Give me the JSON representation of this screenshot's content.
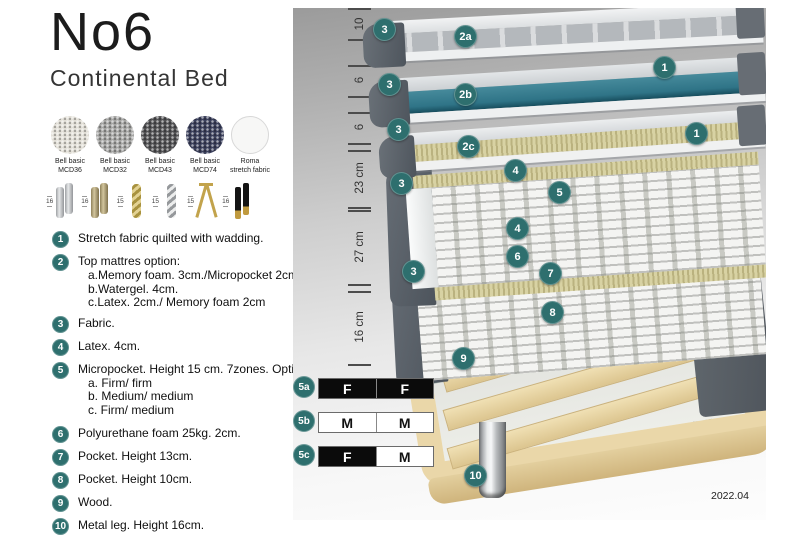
{
  "header": {
    "title": "No6",
    "subtitle": "Continental Bed"
  },
  "swatches": [
    {
      "line1": "Bell basic",
      "line2": "MCD36",
      "color": "#e2dfd7"
    },
    {
      "line1": "Bell basic",
      "line2": "MCD32",
      "color": "#a5a5a3"
    },
    {
      "line1": "Bell basic",
      "line2": "MCD43",
      "color": "#525254"
    },
    {
      "line1": "Bell basic",
      "line2": "MCD74",
      "color": "#3b405c"
    },
    {
      "line1": "Roma",
      "line2": "stretch fabric",
      "color": "#f7f7f6"
    }
  ],
  "legs": [
    {
      "height": "16",
      "type": "cylinder-silver"
    },
    {
      "height": "16",
      "type": "cylinder-brass"
    },
    {
      "height": "15",
      "type": "twisted-gold"
    },
    {
      "height": "15",
      "type": "twisted-silver"
    },
    {
      "height": "15",
      "type": "hairpin-gold"
    },
    {
      "height": "16",
      "type": "block-black-gold"
    }
  ],
  "list": [
    {
      "num": "1",
      "text": "Stretch fabric quilted with wadding."
    },
    {
      "num": "2",
      "text": "Top mattres option:",
      "subs": [
        "a.Memory foam. 3cm./Micropocket 2cm",
        "b.Watergel. 4cm.",
        "c.Latex. 2cm./ Memory foam 2cm"
      ]
    },
    {
      "num": "3",
      "text": "Fabric."
    },
    {
      "num": "4",
      "text": "Latex. 4cm."
    },
    {
      "num": "5",
      "text": "Micropocket. Height 15 cm. 7zones. Option:",
      "subs": [
        "a. Firm/ firm",
        "b. Medium/ medium",
        "c. Firm/ medium"
      ]
    },
    {
      "num": "6",
      "text": "Polyurethane foam 25kg. 2cm."
    },
    {
      "num": "7",
      "text": "Pocket. Height 13cm."
    },
    {
      "num": "8",
      "text": "Pocket. Height 10cm."
    },
    {
      "num": "9",
      "text": "Wood."
    },
    {
      "num": "10",
      "text": "Metal leg. Height 16cm."
    }
  ],
  "measurements": [
    "10",
    "6",
    "6",
    "23 cm",
    "27 cm",
    "16 cm"
  ],
  "callouts": [
    {
      "label": "3"
    },
    {
      "label": "2a"
    },
    {
      "label": "1"
    },
    {
      "label": "3"
    },
    {
      "label": "2b"
    },
    {
      "label": "1"
    },
    {
      "label": "3"
    },
    {
      "label": "2c"
    },
    {
      "label": "4"
    },
    {
      "label": "3"
    },
    {
      "label": "5"
    },
    {
      "label": "4"
    },
    {
      "label": "6"
    },
    {
      "label": "7"
    },
    {
      "label": "3"
    },
    {
      "label": "8"
    },
    {
      "label": "9"
    },
    {
      "label": "10"
    }
  ],
  "firmness_rows": [
    {
      "id": "5a",
      "cells": [
        "F",
        "F"
      ]
    },
    {
      "id": "5b",
      "cells": [
        "M",
        "M"
      ]
    },
    {
      "id": "5c",
      "cells": [
        "F",
        "M"
      ]
    }
  ],
  "footer": {
    "version": "2022.04"
  },
  "colors": {
    "accent_teal": "#2e6f6e",
    "watergel_teal": "#38808f",
    "fabric_gray": "#565d65",
    "latex_cream": "#d8d2a3",
    "wood": "#ead7a9"
  }
}
